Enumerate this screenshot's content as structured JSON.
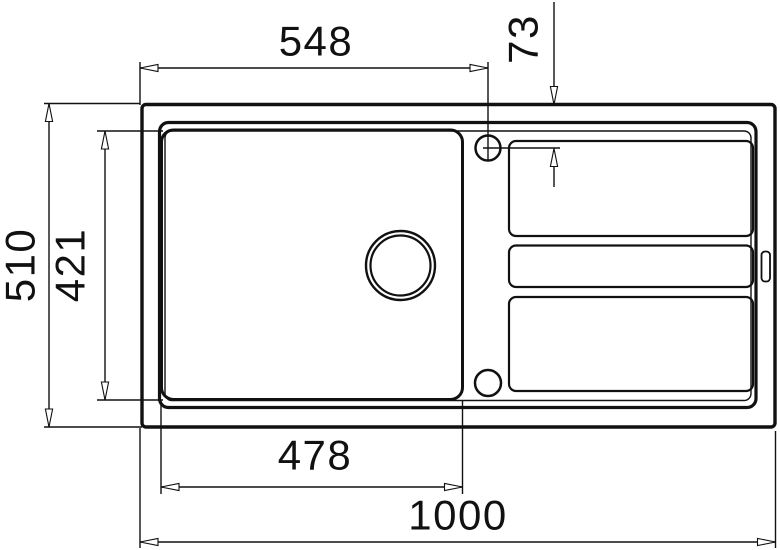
{
  "drawing": {
    "type": "technical-dimension-drawing",
    "subject": "kitchen sink top view with bowl, drain, tap holes and ribbed drainboard",
    "colors": {
      "line": "#111111",
      "background": "#ffffff"
    }
  },
  "dimensions": {
    "top_width": "548",
    "tap_hole_offset": "73",
    "overall_depth": "510",
    "bowl_depth": "421",
    "bowl_width": "478",
    "overall_width": "1000"
  }
}
